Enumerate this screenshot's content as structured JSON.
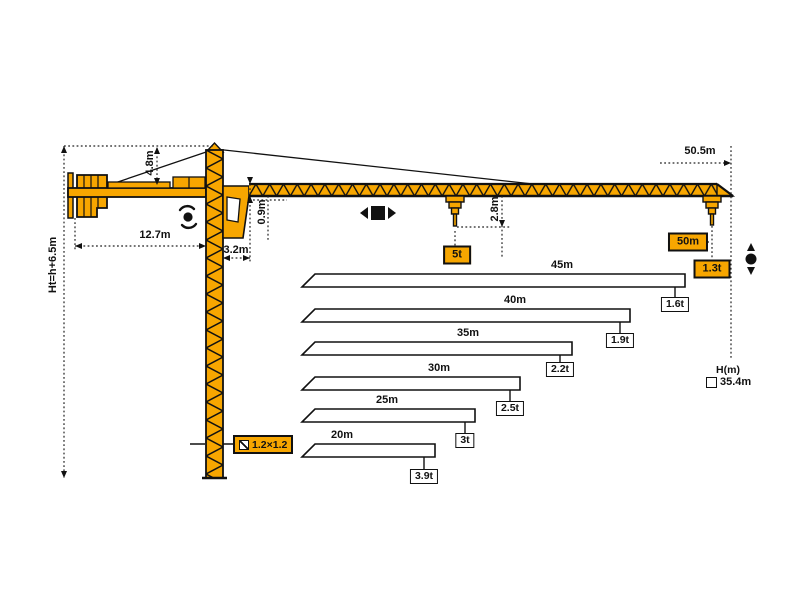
{
  "colors": {
    "crane_orange": "#F7A600",
    "outline": "#111111",
    "bar_fill": "#FFFFFF",
    "background": "#FFFFFF"
  },
  "crane": {
    "height_formula": "Ht=h+6.5m",
    "apex_height": "4.8m",
    "counterjib_length": "12.7m",
    "min_trolley_radius": "3.2m",
    "jib_section_height": "0.9m",
    "hook_drop": "2.8m",
    "max_radius": "50.5m",
    "tip_radius_label": "50m",
    "tip_capacity_label": "1.3t",
    "max_capacity_label": "5t",
    "mast_section_label": "1.2×1.2",
    "height_axis_label": "H(m)",
    "freestanding_height": "35.4m"
  },
  "icons": {
    "rotate": "slewing-rotation",
    "trolley": "trolley-travel-left-right",
    "hoist": "hoist-up-down",
    "section": "mast-cross-section",
    "checkbox": "height-marker"
  },
  "chart_data": {
    "type": "bar",
    "title": "",
    "xlabel": "jib length",
    "ylabel": "capacity at jib tip (t)",
    "categories": [
      "45m",
      "40m",
      "35m",
      "30m",
      "25m",
      "20m"
    ],
    "values": [
      1.6,
      1.9,
      2.2,
      2.5,
      3.0,
      3.9
    ],
    "unit": "t",
    "max_jib": {
      "length": "50m",
      "capacity": "1.3t"
    },
    "max_capacity": "5t",
    "freestanding_height": "35.4m",
    "rows": [
      {
        "length": "45m",
        "capacity": "1.6t"
      },
      {
        "length": "40m",
        "capacity": "1.9t"
      },
      {
        "length": "35m",
        "capacity": "2.2t"
      },
      {
        "length": "30m",
        "capacity": "2.5t"
      },
      {
        "length": "25m",
        "capacity": "3t"
      },
      {
        "length": "20m",
        "capacity": "3.9t"
      }
    ]
  }
}
